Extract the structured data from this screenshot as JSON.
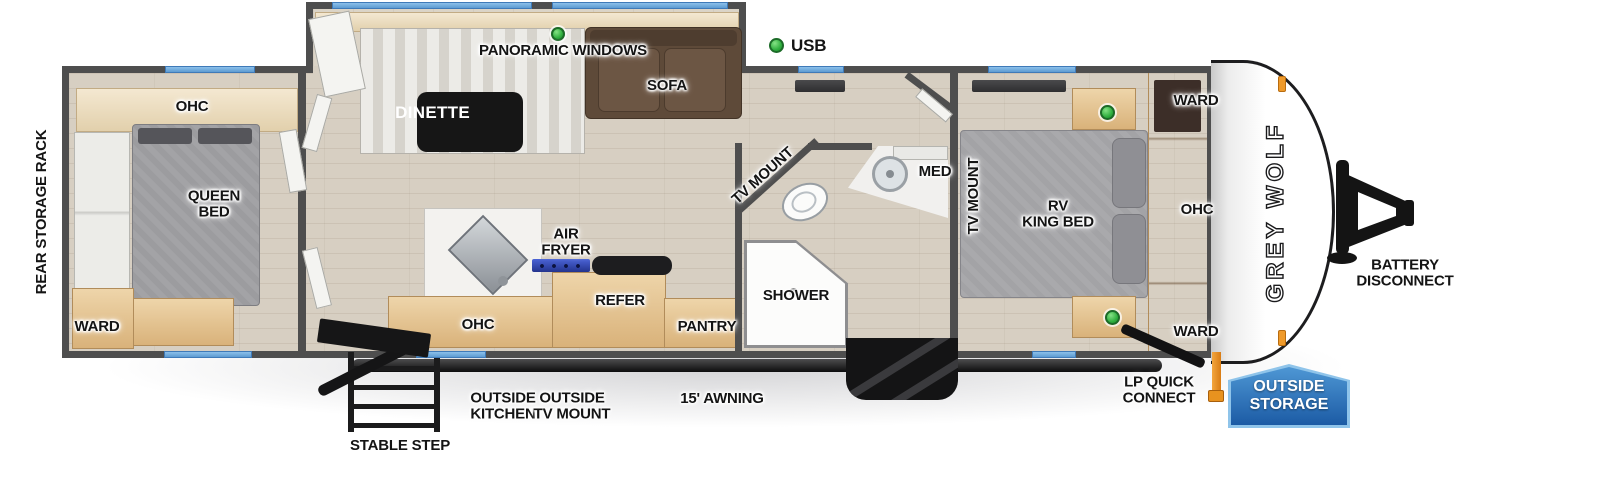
{
  "legend": {
    "usb": "USB"
  },
  "exterior": {
    "brand_logo": "GREY WOLF",
    "rear_storage_rack": "REAR STORAGE RACK",
    "battery_disconnect": "BATTERY\nDISCONNECT",
    "lp_quick_connect": "LP QUICK\nCONNECT",
    "outside_storage": "OUTSIDE\nSTORAGE",
    "stable_step": "STABLE STEP",
    "outside_kitchen": "OUTSIDE\nKITCHEN",
    "outside_tv_mount": "OUTSIDE\nTV MOUNT",
    "awning": "15' AWNING"
  },
  "rear_bedroom": {
    "ohc": "OHC",
    "queen_bed": "QUEEN\nBED",
    "ward": "WARD"
  },
  "living_area": {
    "panoramic_windows": "PANORAMIC WINDOWS",
    "dinette": "DINETTE",
    "sofa": "SOFA"
  },
  "kitchen": {
    "air_fryer": "AIR\nFRYER",
    "ohc": "OHC",
    "refer": "REFER",
    "pantry": "PANTRY"
  },
  "bathroom": {
    "shower": "SHOWER",
    "med": "MED",
    "tv_mount": "TV MOUNT"
  },
  "front_bedroom": {
    "tv_mount": "TV MOUNT",
    "rv_king_bed": "RV\nKING BED",
    "ward_top": "WARD",
    "ohc": "OHC",
    "ward_bottom": "WARD"
  },
  "colors": {
    "wall_gray": "#4e4e4e",
    "floor_tan": "#d7cfc2",
    "wood_tan": "#e3c493",
    "window_blue": "#6fa9de",
    "usb_green": "#35b54a",
    "badge_blue": "#2a6db6",
    "accent_orange": "#e8921f",
    "awning_black": "#141415"
  }
}
